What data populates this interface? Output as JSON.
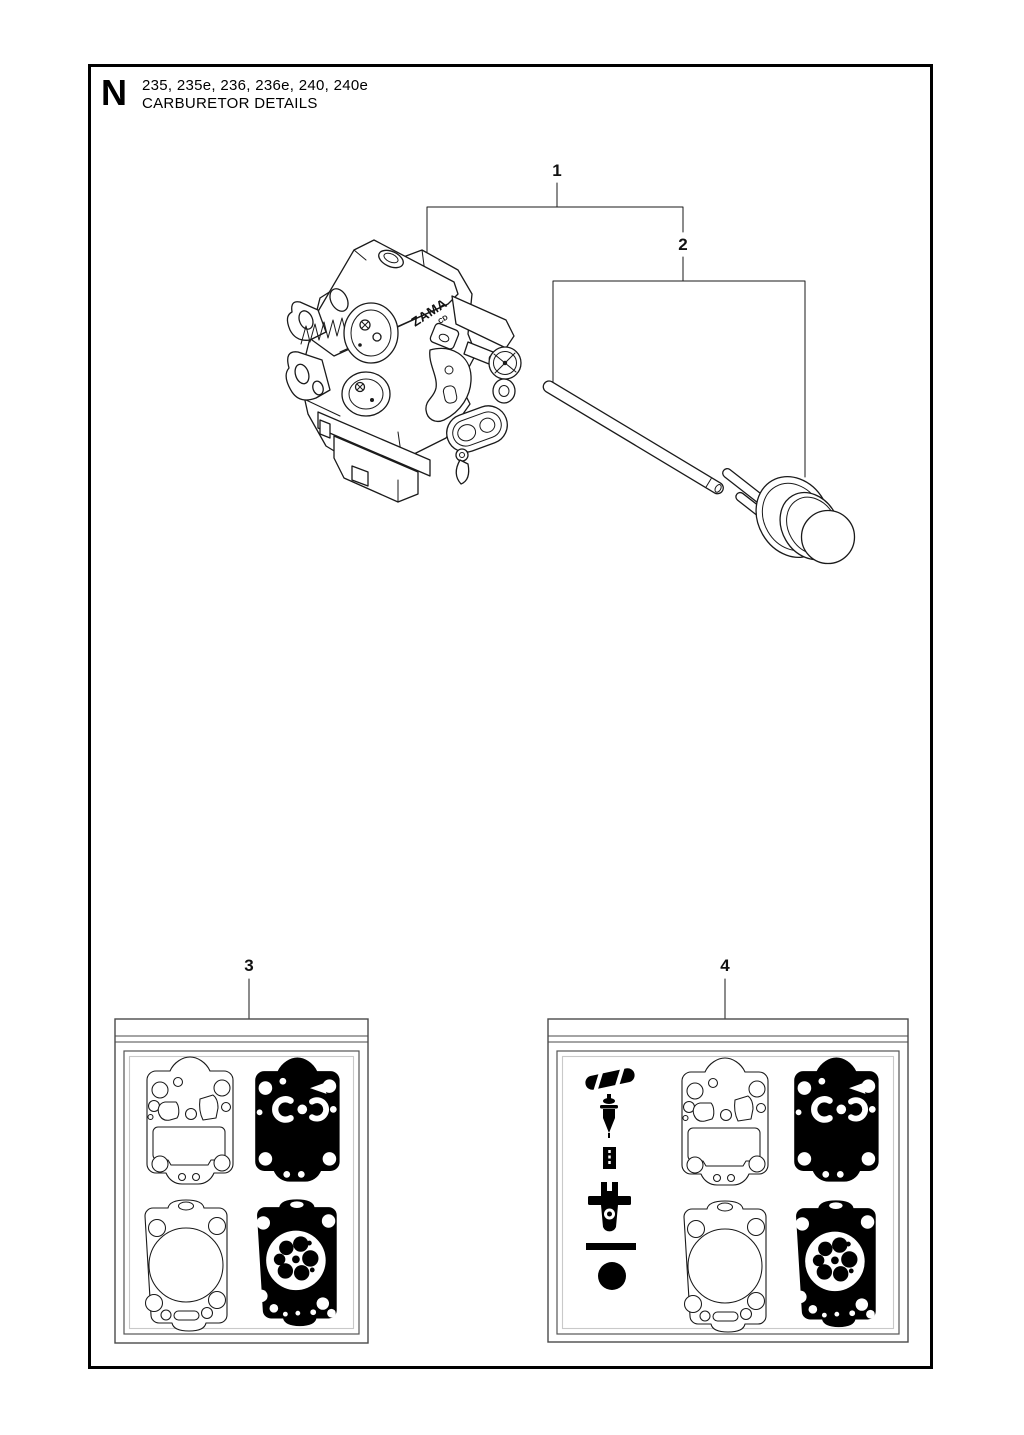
{
  "page": {
    "section_letter": "N",
    "models": "235, 235e, 236, 236e, 240, 240e",
    "title": "CARBURETOR DETAILS"
  },
  "carburetor_label": {
    "brand": "ZAMA",
    "code": "CD"
  },
  "callouts": [
    {
      "label": "1"
    },
    {
      "label": "2"
    },
    {
      "label": "3"
    },
    {
      "label": "4"
    }
  ],
  "colors": {
    "line": "#1a1a1a",
    "black_fill": "#000000",
    "paper": "#ffffff",
    "package_line": "#4a4a4a"
  }
}
